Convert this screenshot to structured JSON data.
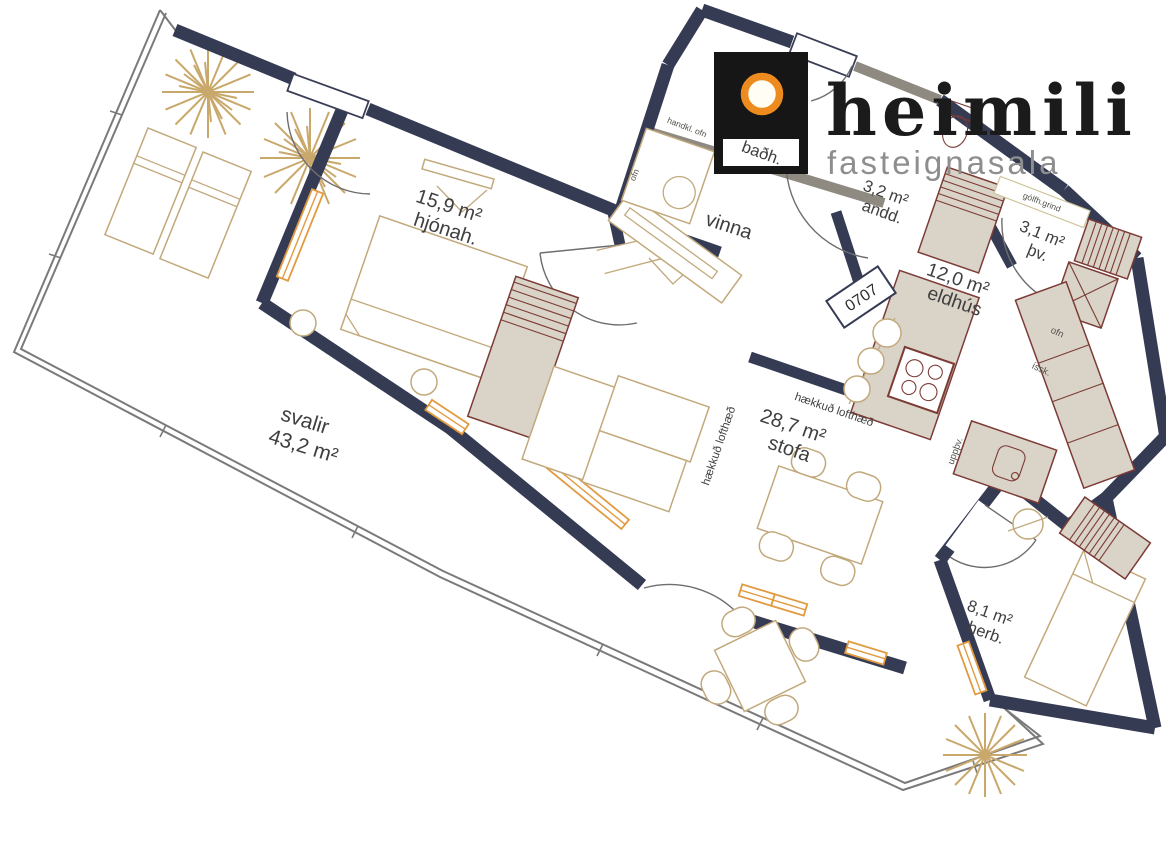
{
  "logo": {
    "brand": "heimili",
    "tagline": "fasteignasala"
  },
  "unit_number": "0707",
  "rooms": {
    "svalir": {
      "name": "svalir",
      "area": "43,2 m²"
    },
    "hjonah": {
      "name": "hjónah.",
      "area": "15,9 m²"
    },
    "vinna": {
      "name": "vinna"
    },
    "badh": {
      "name": "baðh."
    },
    "andd": {
      "name": "andd.",
      "area": "3,2 m²"
    },
    "tv": {
      "name": "þv.",
      "area": "3,1 m²"
    },
    "eldhus": {
      "name": "eldhús",
      "area": "12,0 m²"
    },
    "stofa": {
      "name": "stofa",
      "area": "28,7 m²"
    },
    "herb": {
      "name": "herb.",
      "area": "8,1 m²"
    }
  },
  "annotations": {
    "raised_ceiling": "hækkuð lofthæð",
    "towel_radiator": "handkl. ofn",
    "floor_manifold": "gólfh.grind",
    "oven": "ofn",
    "fridge": "íssk.",
    "dishwasher": "uppþv."
  },
  "colors": {
    "wall": "#363b54",
    "secondary_wall": "#8f8a81",
    "cabinet_fill": "#d9d3c8",
    "cabinet_stroke": "#7c3b35",
    "window": "#e29a40",
    "furniture_outline": "#c2a97c",
    "label_text": "#3f3f3f",
    "logo_orange": "#ee8b1e",
    "logo_black": "#161616",
    "tagline_gray": "#8e8e8e"
  }
}
